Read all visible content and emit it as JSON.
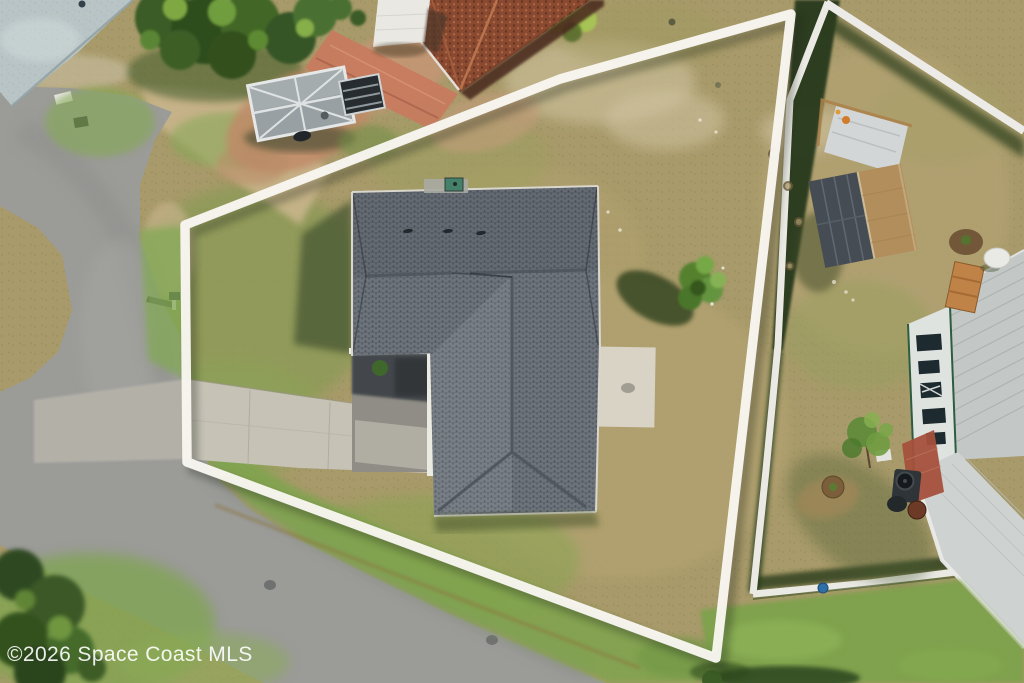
{
  "watermark": {
    "text": "©2026 Space Coast MLS"
  },
  "colors": {
    "boundary_line": "#f8f6f0",
    "fence_white": "#eae9e4",
    "watermark_text": "#ffffff",
    "asphalt": "#9b9b98",
    "lawn_base": "#a89a6a",
    "verge_green": "#7ea34d",
    "lawn_bright_green": "#7ba24b",
    "shingle_gray": "#6d737b",
    "terracotta": "#8a4a31",
    "patio_pink": "#c97a5e",
    "dirt_pink": "#c08a67",
    "trailer_gray": "#98a0a3",
    "shed_tan": "#b28e5d",
    "shed_panel": "#454c53",
    "tarp_silver": "#d3d6d7",
    "metal_roof": "#c3c8c6",
    "porch_roof": "#ced2d0",
    "wall_white": "#dfe3df",
    "trim_green": "#2e5c40",
    "patio_brick": "#a4503c",
    "concrete_driveway": "#c6c2b6",
    "concrete_apron": "#b5b2a9",
    "concrete_pad": "#d8d3c5",
    "concrete_blue": "#b8c4c6",
    "hedge_dark": "#26371b",
    "shadow_green": "#4c5a35",
    "sand": "#cbb68d"
  },
  "scene": {
    "type": "aerial-drone-photo",
    "objects": [
      "property-boundary-outline",
      "subject-house-shingle-roof",
      "driveway",
      "curved-street",
      "lawn",
      "shade-tree-shadow",
      "neighbor-vinyl-fence",
      "neighbor-shed",
      "neighbor-tarp",
      "utility-trailer",
      "terracotta-roof-house",
      "metal-roof-house",
      "mailbox",
      "watermark"
    ]
  }
}
